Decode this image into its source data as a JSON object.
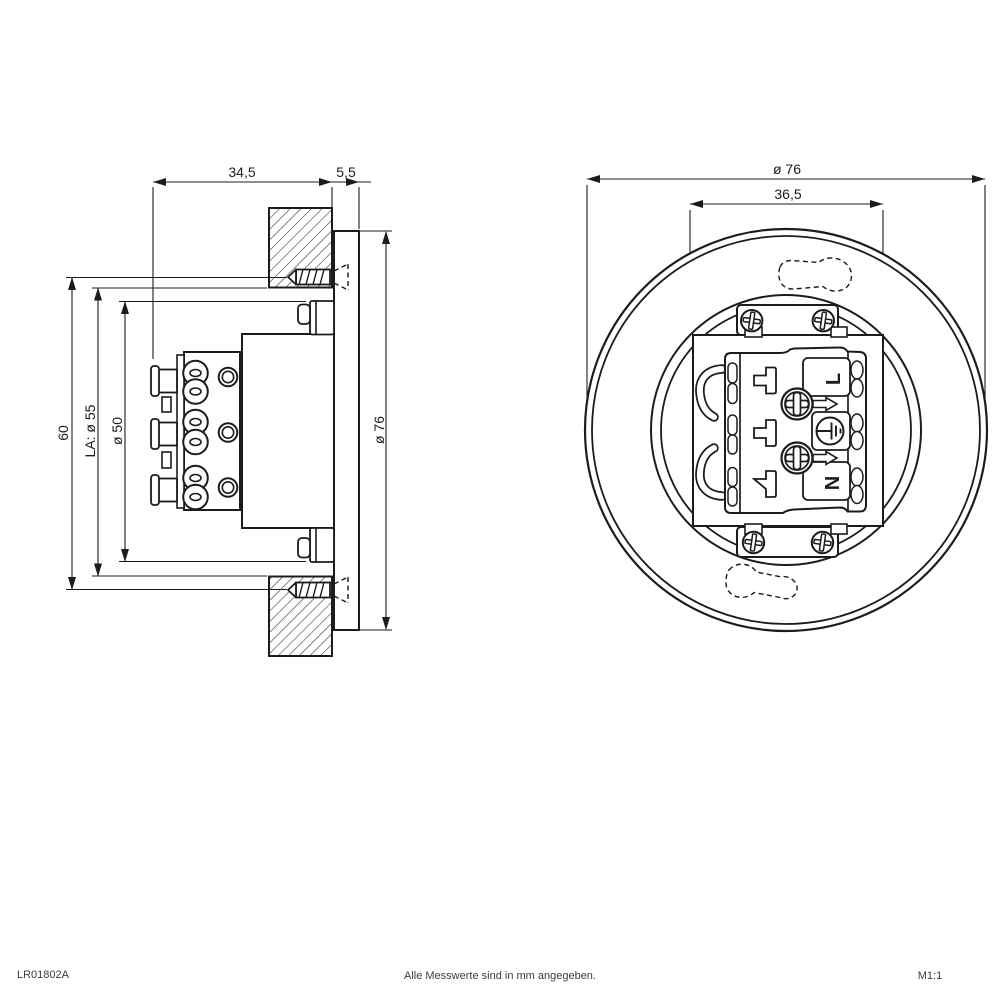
{
  "drawing": {
    "title_note": "Alle Messwerte sind in mm angegeben.",
    "doc_number": "LR01802A",
    "scale_label": "M1:1"
  },
  "side_view": {
    "dims": {
      "recess_depth": "34,5",
      "flange_thickness": "5,5",
      "screw_spacing": "60",
      "cutout_dia": "LA: ø 55",
      "housing_dia": "ø 50",
      "flange_dia": "ø 76"
    }
  },
  "front_view": {
    "dims": {
      "outer_dia": "ø 76",
      "terminal_box_width": "36,5"
    },
    "terminal": {
      "live_label": "L",
      "neutral_label": "N",
      "earth_icon": "earth-ground-icon"
    },
    "icons": [
      "phillips-screw-icon",
      "earth-ground-icon",
      "cable-knockout-icon",
      "mounting-screw-icon"
    ]
  },
  "colors": {
    "line": "#1c1c1c",
    "background": "#ffffff",
    "footer_text": "#3c3c3c"
  }
}
